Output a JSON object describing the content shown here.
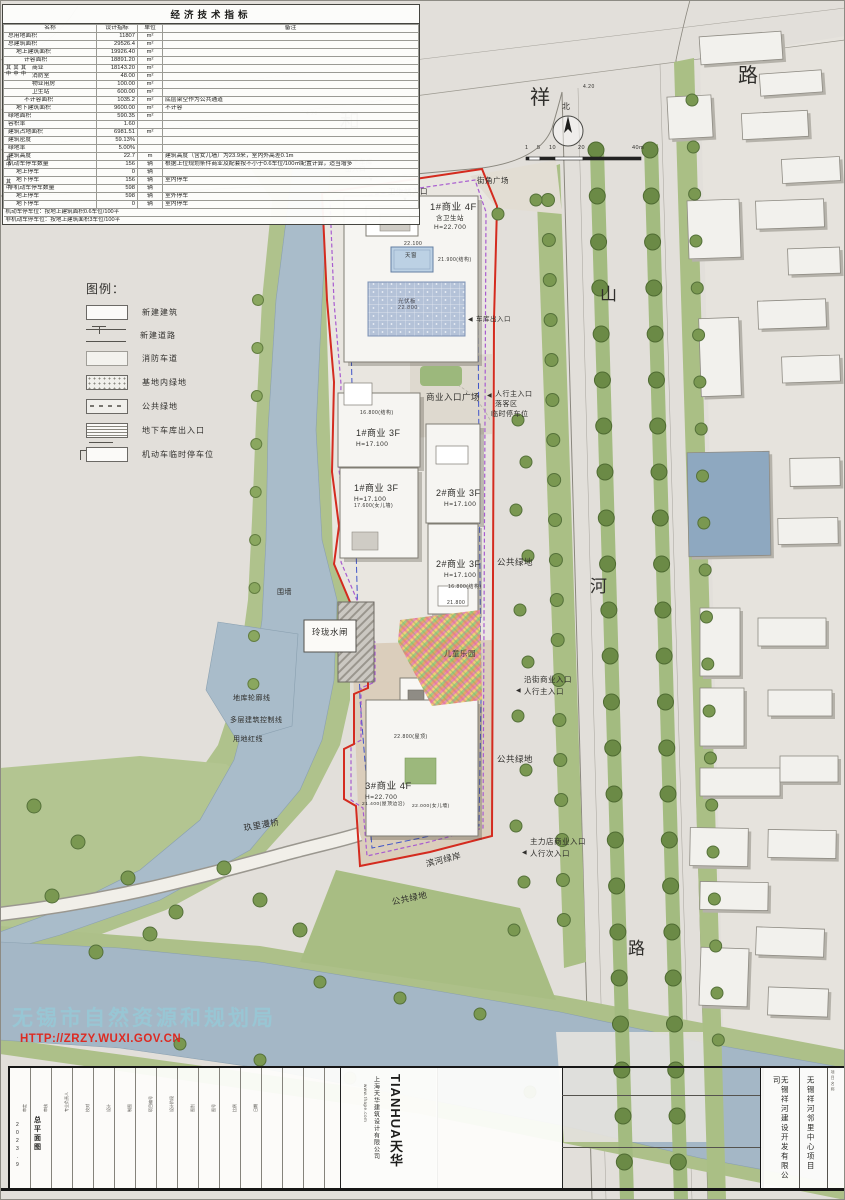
{
  "colors": {
    "boundary_red": "#d42b1f",
    "control_purple": "#a85cd0",
    "garage_blue": "#4054c8",
    "river": "#a9bcca",
    "green": "#afc28c",
    "watermark_blue": "rgba(150,201,214,0.85)",
    "watermark_red": "#dd2a22"
  },
  "indicator_table": {
    "title": "经济技术指标",
    "headers": [
      "名称",
      "设计指标",
      "单位",
      "备注"
    ],
    "qizhong_label": "其\n中",
    "rows": [
      {
        "name": "总用地面积",
        "value": "11807",
        "unit": "m²",
        "note": "",
        "indent": 0
      },
      {
        "name": "总建筑面积",
        "value": "29526.4",
        "unit": "m²",
        "note": "",
        "indent": 0
      },
      {
        "name": "地上建筑面积",
        "value": "19926.40",
        "unit": "m²",
        "note": "",
        "indent": 1
      },
      {
        "name": "计容面积",
        "value": "18891.20",
        "unit": "m²",
        "note": "",
        "indent": 2
      },
      {
        "name": "商业",
        "value": "18143.20",
        "unit": "m²",
        "note": "",
        "indent": 3
      },
      {
        "name": "消防室",
        "value": "48.00",
        "unit": "m²",
        "note": "",
        "indent": 3
      },
      {
        "name": "物业用房",
        "value": "100.00",
        "unit": "m²",
        "note": "",
        "indent": 3
      },
      {
        "name": "卫生站",
        "value": "600.00",
        "unit": "m²",
        "note": "",
        "indent": 3
      },
      {
        "name": "不计容面积",
        "value": "1035.2",
        "unit": "m²",
        "note": "底层架空作为公共通道",
        "indent": 2
      },
      {
        "name": "地下建筑面积",
        "value": "9600.00",
        "unit": "m²",
        "note": "不计容",
        "indent": 1
      },
      {
        "name": "绿地面积",
        "value": "590.35",
        "unit": "m²",
        "note": "",
        "indent": 0
      },
      {
        "name": "容积率",
        "value": "1.60",
        "unit": "",
        "note": "",
        "indent": 0
      },
      {
        "name": "建筑占地面积",
        "value": "6981.51",
        "unit": "m²",
        "note": "",
        "indent": 0
      },
      {
        "name": "建筑密度",
        "value": "59.13%",
        "unit": "",
        "note": "",
        "indent": 0
      },
      {
        "name": "绿地率",
        "value": "5.00%",
        "unit": "",
        "note": "",
        "indent": 0
      },
      {
        "name": "建筑高度",
        "value": "22.7",
        "unit": "m",
        "note": "建筑高度（含女儿墙）为23.9米，室内外高差0.1m",
        "indent": 0
      },
      {
        "name": "机动车停车数量",
        "value": "156",
        "unit": "辆",
        "note": "根据上位规划条件商业及配套按不小于0.6车位/100㎡配置计算，适当增多",
        "indent": 0
      },
      {
        "name": "地上停车",
        "value": "0",
        "unit": "辆",
        "note": "",
        "indent": 1
      },
      {
        "name": "地下停车",
        "value": "156",
        "unit": "辆",
        "note": "室内停车",
        "indent": 1
      },
      {
        "name": "非机动车停车数量",
        "value": "598",
        "unit": "辆",
        "note": "",
        "indent": 0
      },
      {
        "name": "地上停车",
        "value": "598",
        "unit": "辆",
        "note": "室外停车",
        "indent": 1
      },
      {
        "name": "地下停车",
        "value": "0",
        "unit": "辆",
        "note": "室内停车",
        "indent": 1
      }
    ],
    "footnotes": [
      "机动车停车位：按地上建筑面积0.6车位/100平",
      "非机动车停车位：按地上建筑面积3车位/100平"
    ]
  },
  "legend": {
    "title": "图例：",
    "items": [
      {
        "label": "新建建筑",
        "swatch": "bld"
      },
      {
        "label": "新建道路",
        "swatch": "road"
      },
      {
        "label": "消防车道",
        "swatch": "fire"
      },
      {
        "label": "基地内绿地",
        "swatch": "sitegreen"
      },
      {
        "label": "公共绿地",
        "swatch": "pubgreen"
      },
      {
        "label": "地下车库出入口",
        "swatch": "garage"
      },
      {
        "label": "机动车临时停车位",
        "swatch": "parking"
      }
    ]
  },
  "plan": {
    "north_label": "北",
    "scale_ticks": [
      "1",
      "5",
      "10",
      "20",
      "40m"
    ],
    "labels": [
      {
        "t": "和",
        "x": 340,
        "y": 112,
        "s": 20
      },
      {
        "t": "祥",
        "x": 530,
        "y": 88,
        "s": 20
      },
      {
        "t": "路",
        "x": 738,
        "y": 66,
        "s": 20
      },
      {
        "t": "山",
        "x": 600,
        "y": 286,
        "s": 17
      },
      {
        "t": "河",
        "x": 590,
        "y": 578,
        "s": 17
      },
      {
        "t": "路",
        "x": 628,
        "y": 940,
        "s": 17
      },
      {
        "t": "北",
        "x": 562,
        "y": 103,
        "s": 8
      },
      {
        "t": "1",
        "x": 525,
        "y": 146,
        "s": 5.5
      },
      {
        "t": "5",
        "x": 537,
        "y": 146,
        "s": 5.5
      },
      {
        "t": "10",
        "x": 549,
        "y": 146,
        "s": 5.5
      },
      {
        "t": "20",
        "x": 578,
        "y": 146,
        "s": 5.5
      },
      {
        "t": "40m",
        "x": 632,
        "y": 146,
        "s": 5.5
      },
      {
        "t": "4.20",
        "x": 583,
        "y": 85,
        "s": 5
      },
      {
        "t": "4.20",
        "x": 306,
        "y": 112,
        "s": 5
      },
      {
        "t": "地下车库\n出入口",
        "x": 345,
        "y": 159,
        "s": 6.5
      },
      {
        "t": "▼",
        "x": 368,
        "y": 177,
        "s": 6
      },
      {
        "t": "街角广场",
        "x": 477,
        "y": 177,
        "s": 7.5
      },
      {
        "t": "卫生站入口",
        "x": 388,
        "y": 188,
        "s": 7.5
      },
      {
        "t": "▼",
        "x": 402,
        "y": 197,
        "s": 6
      },
      {
        "t": "1#商业 4F",
        "x": 430,
        "y": 203,
        "s": 9.5
      },
      {
        "t": "含卫生站",
        "x": 436,
        "y": 215,
        "s": 6.5
      },
      {
        "t": "H=22.700",
        "x": 434,
        "y": 224,
        "s": 6.5
      },
      {
        "t": "22.100",
        "x": 404,
        "y": 242,
        "s": 5
      },
      {
        "t": "天窗",
        "x": 405,
        "y": 254,
        "s": 5.5
      },
      {
        "t": "21.900(结构)",
        "x": 438,
        "y": 258,
        "s": 5
      },
      {
        "t": "光伏板\n22.800",
        "x": 398,
        "y": 300,
        "s": 5.5,
        "c": "#4a4a52"
      },
      {
        "t": "◀",
        "x": 468,
        "y": 317,
        "s": 6
      },
      {
        "t": "车库出入口",
        "x": 476,
        "y": 316,
        "s": 6.5
      },
      {
        "t": "商业入口广场",
        "x": 426,
        "y": 393,
        "s": 8.5
      },
      {
        "t": "◀",
        "x": 487,
        "y": 393,
        "s": 6
      },
      {
        "t": "人行主入口",
        "x": 495,
        "y": 391,
        "s": 7
      },
      {
        "t": "落客区",
        "x": 495,
        "y": 401,
        "s": 7
      },
      {
        "t": "临时停车位",
        "x": 491,
        "y": 411,
        "s": 7
      },
      {
        "t": "16.800(结构)",
        "x": 360,
        "y": 411,
        "s": 5
      },
      {
        "t": "1#商业 3F",
        "x": 356,
        "y": 429,
        "s": 9
      },
      {
        "t": "H=17.100",
        "x": 356,
        "y": 441,
        "s": 6.5
      },
      {
        "t": "1#商业 3F",
        "x": 354,
        "y": 484,
        "s": 9
      },
      {
        "t": "H=17.100",
        "x": 354,
        "y": 496,
        "s": 6.5
      },
      {
        "t": "17.600(女儿墙)",
        "x": 354,
        "y": 504,
        "s": 5
      },
      {
        "t": "2#商业 3F",
        "x": 436,
        "y": 489,
        "s": 9
      },
      {
        "t": "H=17.100",
        "x": 444,
        "y": 501,
        "s": 6.5
      },
      {
        "t": "2#商业 3F",
        "x": 436,
        "y": 560,
        "s": 9
      },
      {
        "t": "H=17.100",
        "x": 444,
        "y": 572,
        "s": 6.5
      },
      {
        "t": "16.800(结构)",
        "x": 448,
        "y": 585,
        "s": 5
      },
      {
        "t": "21.800",
        "x": 447,
        "y": 601,
        "s": 5
      },
      {
        "t": "公共绿地",
        "x": 497,
        "y": 558,
        "s": 8.5
      },
      {
        "t": "玲珑水闸",
        "x": 312,
        "y": 628,
        "s": 8.5
      },
      {
        "t": "围墙",
        "x": 277,
        "y": 589,
        "s": 7
      },
      {
        "t": "儿童乐园",
        "x": 444,
        "y": 650,
        "s": 7.5,
        "c": "#3c3c38"
      },
      {
        "t": "沿街商业入口",
        "x": 524,
        "y": 676,
        "s": 7.5
      },
      {
        "t": "◀",
        "x": 516,
        "y": 688,
        "s": 6
      },
      {
        "t": "人行主入口",
        "x": 524,
        "y": 688,
        "s": 7.5
      },
      {
        "t": "地库轮廓线",
        "x": 233,
        "y": 695,
        "s": 7
      },
      {
        "t": "多层建筑控制线",
        "x": 230,
        "y": 717,
        "s": 7
      },
      {
        "t": "用地红线",
        "x": 233,
        "y": 736,
        "s": 7
      },
      {
        "t": "公共绿地",
        "x": 497,
        "y": 755,
        "s": 8.5
      },
      {
        "t": "22.800(屋顶)",
        "x": 394,
        "y": 735,
        "s": 5
      },
      {
        "t": "3#商业 4F",
        "x": 365,
        "y": 782,
        "s": 9.5
      },
      {
        "t": "H=22.700",
        "x": 365,
        "y": 794,
        "s": 6.5
      },
      {
        "t": "21.400(屋顶边沿)",
        "x": 362,
        "y": 802,
        "s": 4.8
      },
      {
        "t": "22.000(女儿墙)",
        "x": 412,
        "y": 804,
        "s": 4.8
      },
      {
        "t": "主力店商业入口",
        "x": 530,
        "y": 838,
        "s": 7.5
      },
      {
        "t": "◀",
        "x": 522,
        "y": 850,
        "s": 6
      },
      {
        "t": "人行次入口",
        "x": 530,
        "y": 850,
        "s": 7.5
      },
      {
        "t": "玖里漫桥",
        "x": 243,
        "y": 824,
        "s": 8.5,
        "r": -10
      },
      {
        "t": "滨河绿岸",
        "x": 425,
        "y": 860,
        "s": 8.5,
        "r": -14
      },
      {
        "t": "公共绿地",
        "x": 391,
        "y": 898,
        "s": 8.5,
        "r": -12
      }
    ]
  },
  "watermark": {
    "line1": "无锡市自然资源和规划局",
    "line2": "HTTP://ZRZY.WUXI.GOV.CN"
  },
  "titleblock": {
    "sheet_name": "总平面图",
    "date": "2023.9",
    "brand": "TIANHUA天华",
    "design_firm": "上海天华建筑设计有限公司",
    "website": "www.thape.com",
    "client": "无锡祥河建设开发有限公司",
    "project": "无锡祥河邻里中心项目",
    "right_col_label": "项目名称",
    "cells": [
      "审定",
      "审核",
      "专业负责人",
      "校对",
      "设计",
      "制图",
      "项目编号",
      "设计阶段",
      "图别",
      "图号",
      "比例",
      "日期"
    ]
  }
}
